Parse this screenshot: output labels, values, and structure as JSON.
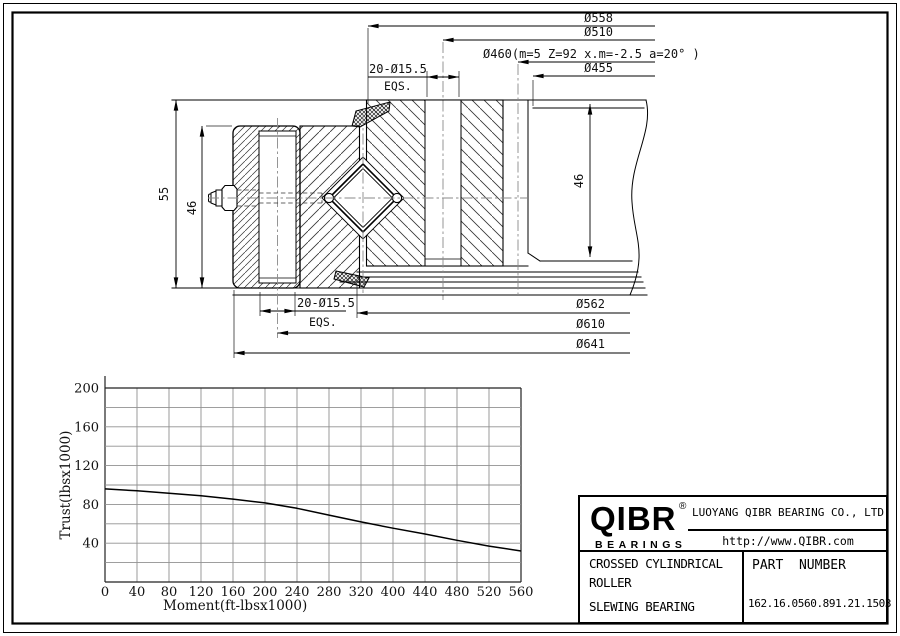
{
  "drawing": {
    "dims_top": [
      "Ø558",
      "Ø510",
      "Ø460(m=5 Z=92 x.m=-2.5 a=20° )",
      "Ø455"
    ],
    "dims_bottom": [
      "Ø562",
      "Ø610",
      "Ø641"
    ],
    "dim_height_overall": "55",
    "dim_height_inner": "46",
    "dim_height_right": "46",
    "hole_callout_top": {
      "text": "20-Ø15.5",
      "note": "EQS."
    },
    "hole_callout_bottom": {
      "text": "20-Ø15.5",
      "note": "EQS."
    }
  },
  "chart_data": {
    "type": "line",
    "title": "",
    "xlabel": "Moment(ft-lbsx1000)",
    "ylabel": "Trust(lbsx1000)",
    "x_tick_labels": [
      "0",
      "40",
      "80",
      "120",
      "160",
      "200",
      "240",
      "280",
      "320",
      "400",
      "440",
      "480",
      "520",
      "560"
    ],
    "y_tick_labels": [
      "200",
      "160",
      "120",
      "80",
      "40"
    ],
    "ylim": [
      0,
      200
    ],
    "y_divisions": 10,
    "grid": true,
    "legend": "none",
    "series": [
      {
        "name": "thrust-vs-moment-capacity",
        "values": [
          96,
          94,
          91.5,
          89,
          85.5,
          81.5,
          76,
          69,
          62,
          55.5,
          49.5,
          43,
          37,
          32
        ]
      }
    ]
  },
  "title_block": {
    "logo_text": "QIBR",
    "logo_sub": "BEARINGS",
    "trademark": "®",
    "company": "LUOYANG QIBR BEARING CO., LTD",
    "website": "http://www.QIBR.com",
    "product_line1": "CROSSED CYLINDRICAL",
    "product_line2": "ROLLER",
    "product_line3": "SLEWING BEARING",
    "part_label": "PART  NUMBER",
    "part_number": "162.16.0560.891.21.1503"
  }
}
